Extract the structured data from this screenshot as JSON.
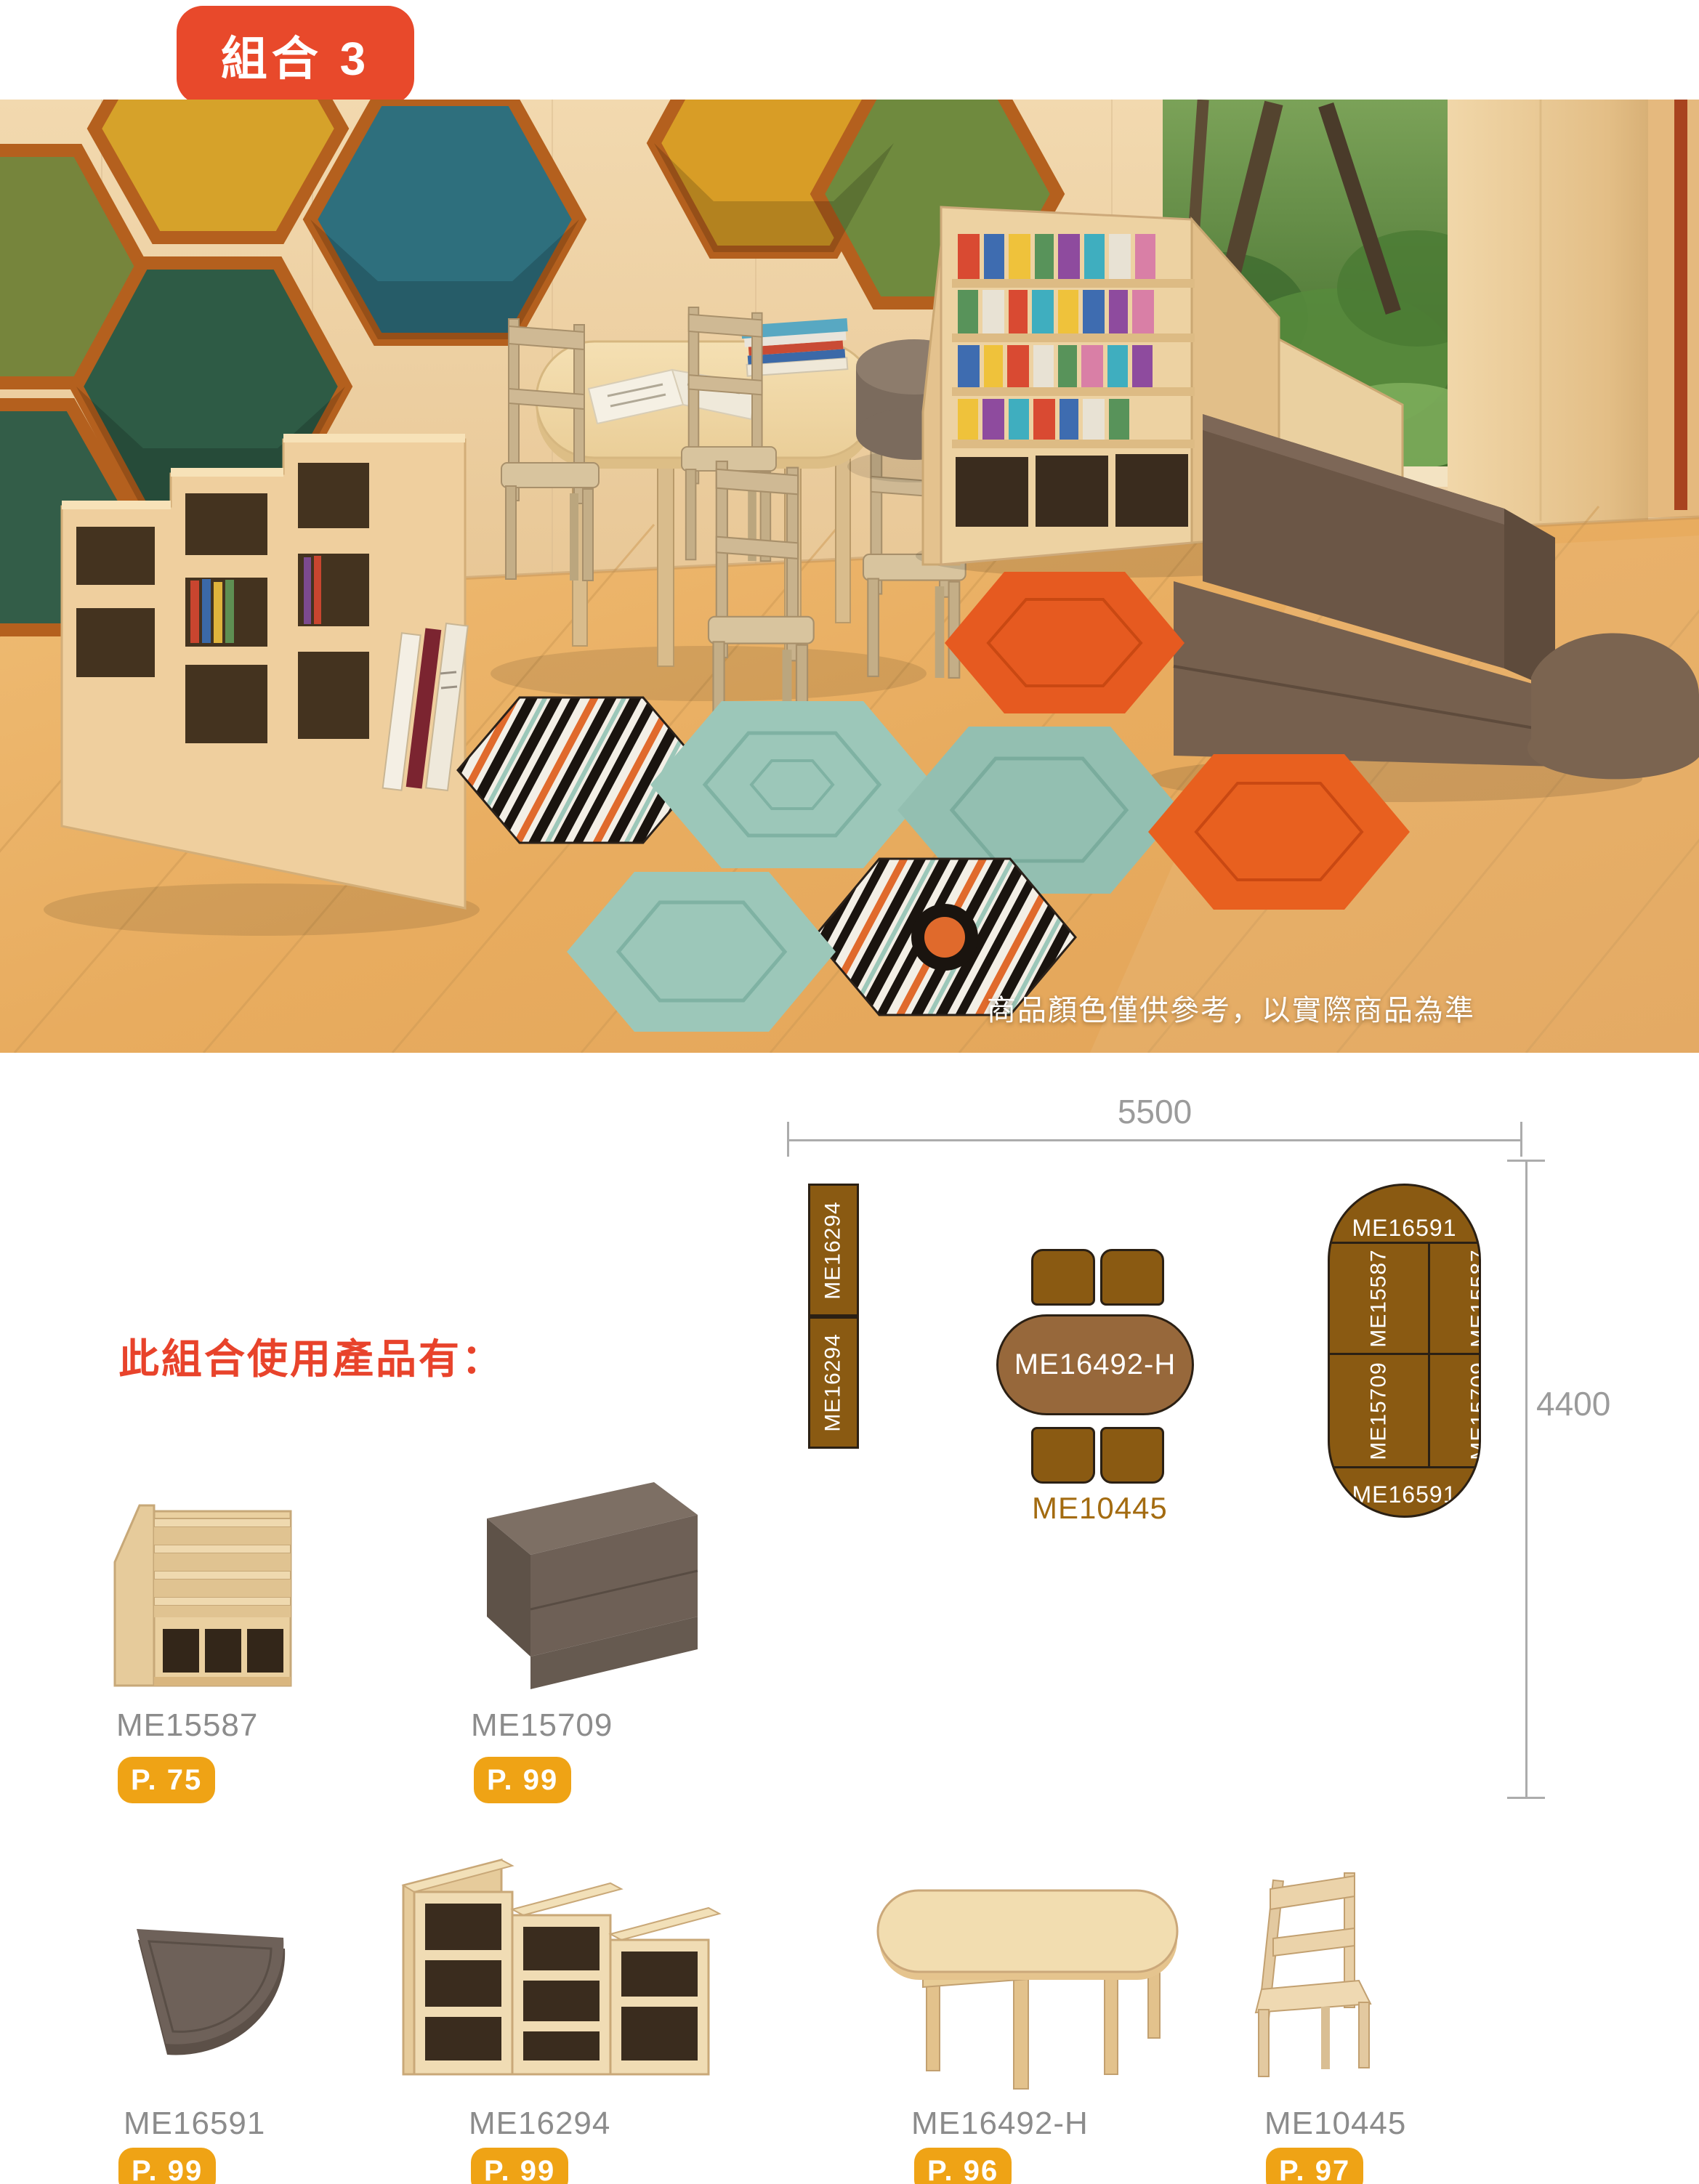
{
  "badge": {
    "label": "組合 3"
  },
  "photo": {
    "caption": "商品顏色僅供參考，以實際商品為準"
  },
  "heading": {
    "text": "此組合使用產品有："
  },
  "plan": {
    "dim_width": "5500",
    "dim_height": "4400",
    "shelf_labels": [
      "ME16294",
      "ME16294"
    ],
    "table_label": "ME16492-H",
    "chairs_label": "ME10445",
    "capsule": {
      "top": "ME16591",
      "cells": [
        "ME15587",
        "ME15587",
        "ME15709",
        "ME15709"
      ],
      "bottom": "ME16591"
    }
  },
  "products": [
    {
      "code": "ME15587",
      "page": "P. 75"
    },
    {
      "code": "ME15709",
      "page": "P. 99"
    },
    {
      "code": "ME16591",
      "page": "P. 99"
    },
    {
      "code": "ME16294",
      "page": "P. 99"
    },
    {
      "code": "ME16492-H",
      "page": "P. 96"
    },
    {
      "code": "ME10445",
      "page": "P. 97"
    }
  ],
  "colors": {
    "badge_red": "#E8492B",
    "heading_red": "#E8432B",
    "page_badge_orange": "#EFA315",
    "plan_brown": "#8A5A12",
    "plan_table_brown": "#97683B",
    "plan_text_brown": "#A36B10",
    "code_grey": "#8C8C8C",
    "dim_grey": "#9B9B9B"
  }
}
